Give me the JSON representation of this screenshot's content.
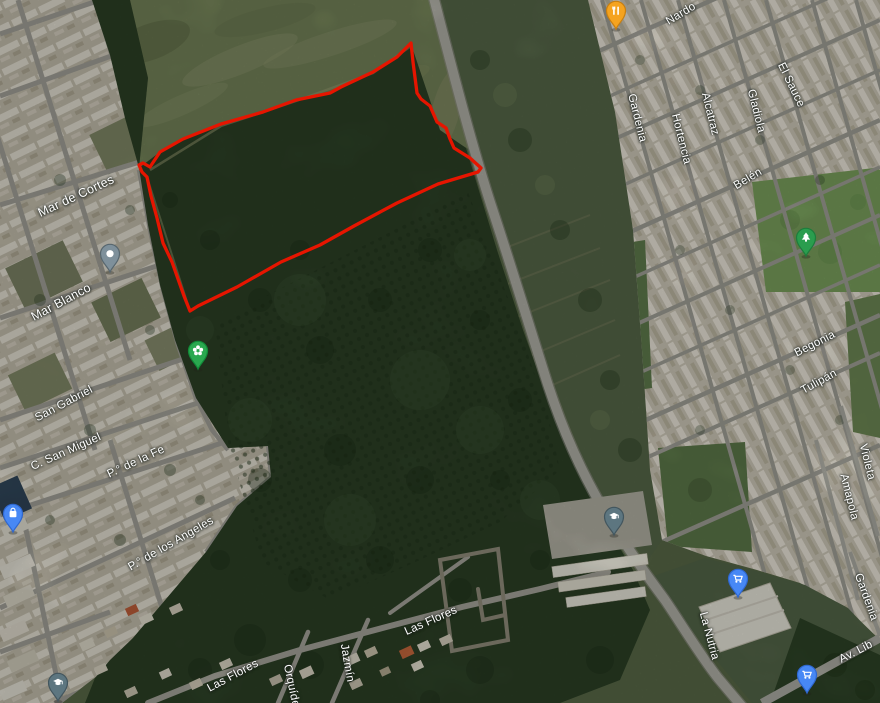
{
  "map": {
    "title": "Satellite map with outlined land parcel",
    "colors": {
      "boundary": "#e61500",
      "road": "#b4b3aa",
      "forest": "#2d4127",
      "field": "#76855a",
      "urban": "#c7c1af",
      "marker_blue": "#4788f5",
      "marker_green": "#2aa84f",
      "marker_slate": "#5d7680",
      "marker_orange": "#f5a31f"
    },
    "street_labels": [
      {
        "id": "mar-de-cortes",
        "text": "Mar de Cortes"
      },
      {
        "id": "mar-blanco",
        "text": "Mar Blanco"
      },
      {
        "id": "san-gabriel",
        "text": "San Gabriel"
      },
      {
        "id": "c-san-miguel",
        "text": "C. San Miguel"
      },
      {
        "id": "p-de-la-fe",
        "text": "P.° de la Fe"
      },
      {
        "id": "p-de-los-angeles",
        "text": "P.° de los Angeles"
      },
      {
        "id": "las-flores-sw",
        "text": "Las Flores"
      },
      {
        "id": "orquidea",
        "text": "Orquídea"
      },
      {
        "id": "jazmin",
        "text": "Jazmín"
      },
      {
        "id": "las-flores",
        "text": "Las Flores"
      },
      {
        "id": "nardo",
        "text": "Nardo"
      },
      {
        "id": "gardenia-top",
        "text": "Gardenia"
      },
      {
        "id": "hortencia",
        "text": "Hortencia"
      },
      {
        "id": "alcatraz",
        "text": "Alcatraz"
      },
      {
        "id": "gladiola",
        "text": "Gladiola"
      },
      {
        "id": "el-sauce",
        "text": "El Sauce"
      },
      {
        "id": "belen",
        "text": "Belén"
      },
      {
        "id": "begonia",
        "text": "Begonia"
      },
      {
        "id": "tulipan",
        "text": "Tulipán"
      },
      {
        "id": "violeta",
        "text": "Violeta"
      },
      {
        "id": "amapola",
        "text": "Amapola"
      },
      {
        "id": "gardenia-bottom",
        "text": "Gardenia"
      },
      {
        "id": "la-nutria",
        "text": "La Nutria"
      },
      {
        "id": "av-lib",
        "text": "Av. Lib"
      }
    ],
    "markers": [
      {
        "name": "saved-place",
        "icon": "dot",
        "color": "#7e909b",
        "transform": "translate(110,272)"
      },
      {
        "name": "garden-place",
        "icon": "flower",
        "color": "#2aa84f",
        "transform": "translate(198,369)"
      },
      {
        "name": "shopping-bag-place",
        "icon": "shopping-bag",
        "color": "#4788f5",
        "transform": "translate(13,532)"
      },
      {
        "name": "school-place-east",
        "icon": "graduation-cap",
        "color": "#5d7680",
        "transform": "translate(614,535)"
      },
      {
        "name": "school-place-southwest",
        "icon": "graduation-cap",
        "color": "#5d7680",
        "transform": "translate(58,701)"
      },
      {
        "name": "restaurant-place",
        "icon": "restaurant",
        "color": "#f5a31f",
        "transform": "translate(616,29)"
      },
      {
        "name": "park-tree-place",
        "icon": "tree",
        "color": "#2a9d4e",
        "transform": "translate(806,256)"
      },
      {
        "name": "supermarket-place-north",
        "icon": "shopping-cart",
        "color": "#4788f5",
        "transform": "translate(738,597)"
      },
      {
        "name": "supermarket-place-south",
        "icon": "shopping-cart",
        "color": "#4788f5",
        "transform": "translate(807,693)"
      }
    ]
  }
}
